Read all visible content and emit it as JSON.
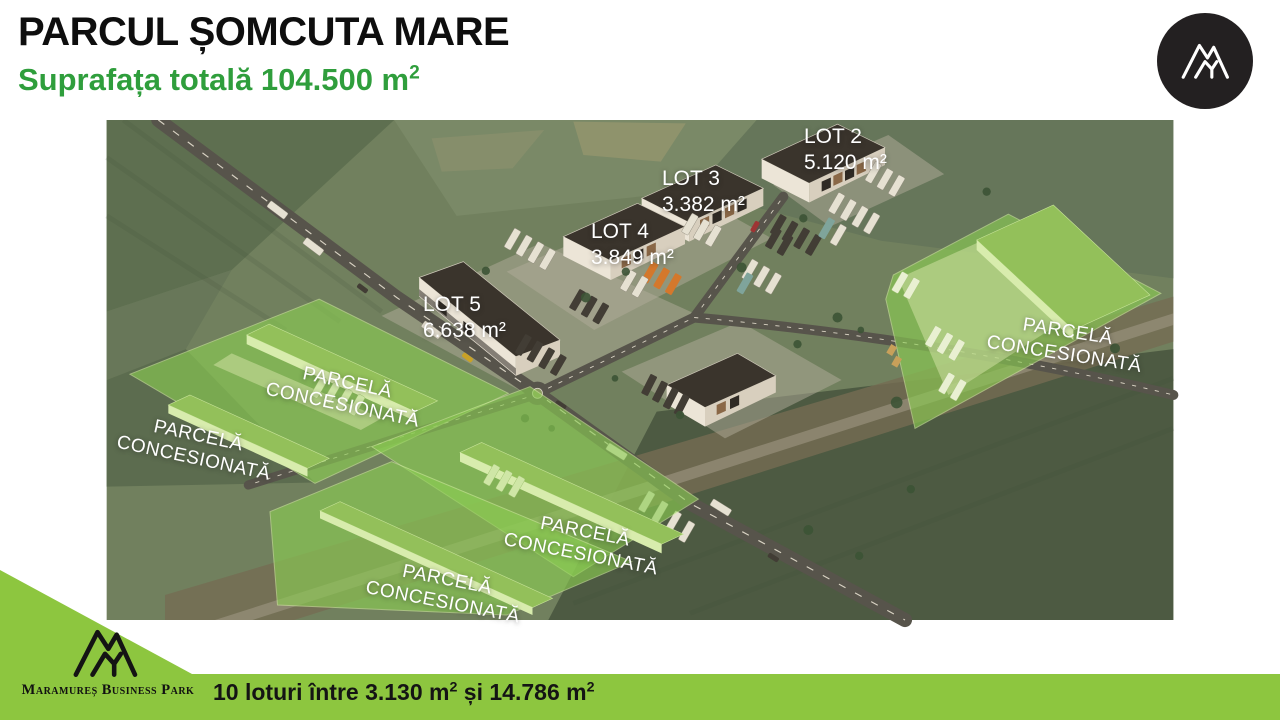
{
  "header": {
    "title": "PARCUL ȘOMCUTA MARE",
    "subtitle_text": "Suprafața totală 104.500 m",
    "subtitle_sup": "2"
  },
  "map": {
    "lots": [
      {
        "name": "LOT 2",
        "area": "5.120 m²"
      },
      {
        "name": "LOT 3",
        "area": "3.382 m²"
      },
      {
        "name": "LOT 4",
        "area": "3.849 m²"
      },
      {
        "name": "LOT 5",
        "area": "6.638 m²"
      }
    ],
    "parcel_label": {
      "line1": "PARCELĂ",
      "line2": "CONCESIONATĂ"
    },
    "parcel_count": 5
  },
  "footer": {
    "brand": "Maramureș Business Park",
    "text_p1": "10 loturi între 3.130 m",
    "sup1": "2",
    "text_p2": " și 14.786 m",
    "sup2": "2"
  },
  "colors": {
    "accent_green": "#2f9e3c",
    "band_green": "#8dc63f",
    "parcel_green": "#8ccf52",
    "logo_bg": "#232021"
  }
}
